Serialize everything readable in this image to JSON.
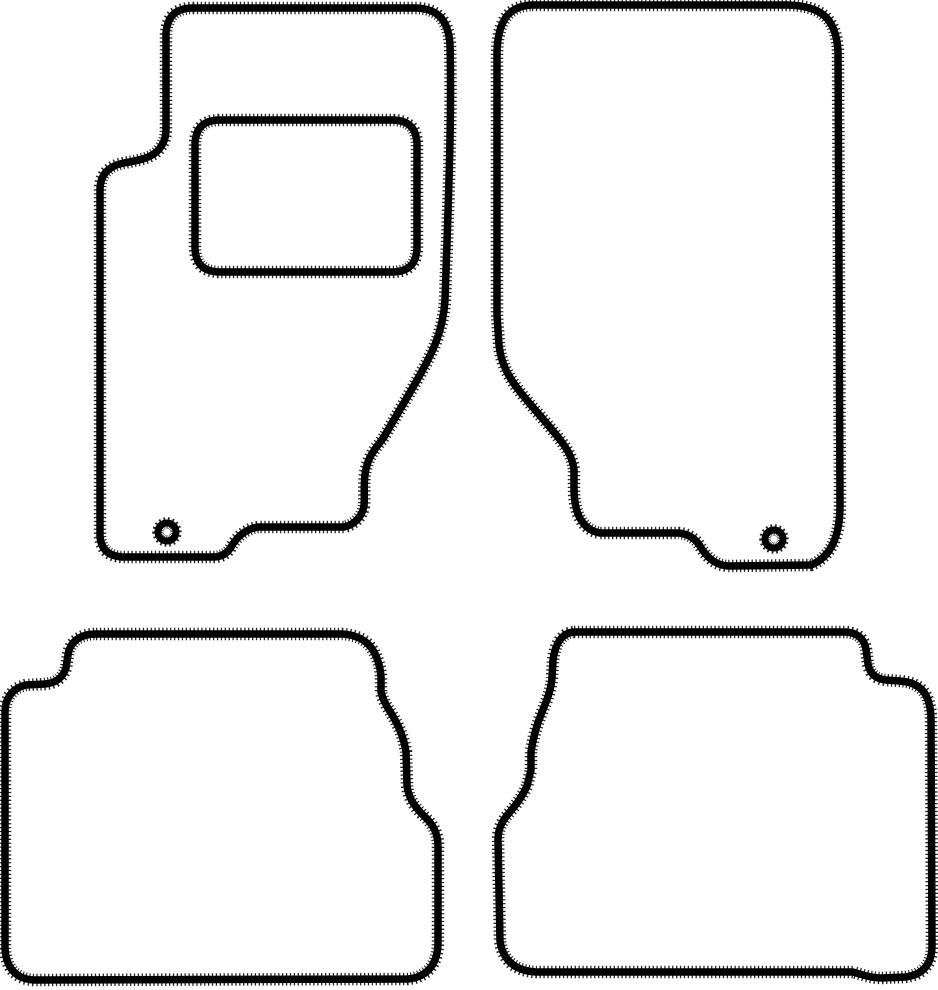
{
  "canvas": {
    "width": 938,
    "height": 990
  },
  "colors": {
    "background": "#ffffff",
    "line": "#000000"
  },
  "stroke": {
    "outline_width": 7.5,
    "texture_width": 12.5
  },
  "mats": {
    "front_left": {
      "name": "front-left-mat",
      "outline": "M 193,8 L 417,8 C 437,9 448,19 450,44 C 452,120 448,210 445,300 C 443,332 432,353 421,373 C 410,393 393,421 384,437 C 376,448 369,455 366,469 C 363,481 365,494 364,506 C 362,517 354,525 344,527 L 258,527 C 245,529 236,538 231,547 C 227,554 221,557 213,557 L 122,557 C 108,556 101,549 100,536 L 100,190 C 100,175 108,166 124,163 C 140,160 153,158 160,148 C 165,141 166,136 166,127 L 166,34 C 167,16 176,8 193,8 Z",
      "heel_pad": "M 218,120 L 394,120 C 409,121 416,128 417,143 L 417,249 C 416,264 409,271 394,272 L 218,272 C 203,271 196,264 195,249 L 195,143 C 196,128 203,121 218,120 Z",
      "eyelet": "M 158,532 a 9,9 0 1 0 18,0 a 9,9 0 1 0 -18,0 Z"
    },
    "front_right": {
      "name": "front-right-mat",
      "outline": "M 532,5 L 788,5 C 820,6 836,17 838,51 L 840,505 C 840,536 831,557 811,565 L 728,566 C 714,565 706,556 700,546 C 695,538 688,534 679,533 L 600,533 C 589,531 582,524 578,514 C 575,506 574,498 574,488 L 574,470 C 573,460 568,450 561,441 C 548,424 532,407 521,393 C 509,378 501,364 499,345 L 497,315 L 497,52 C 498,20 509,6 532,5 Z",
      "eyelet": "M 765,539 a 9,9 0 1 0 18,0 a 9,9 0 1 0 -18,0 Z"
    },
    "rear_left": {
      "name": "rear-left-mat",
      "outline": "M 96,634 L 342,634 C 358,635 368,641 374,652 C 378,659 380,666 381,676 L 381,692 C 383,700 387,707 391,713 C 399,726 404,738 406,752 L 407,785 C 408,797 414,806 422,814 C 432,823 438,832 438,846 L 438,942 C 438,962 429,977 408,979 L 34,980 C 16,979 6,968 5,948 L 5,712 C 5,699 12,688 26,685 L 45,684 C 57,683 63,677 66,668 L 68,655 C 70,641 81,634 96,634 Z"
    },
    "rear_right": {
      "name": "rear-right-mat",
      "outline": "M 574,632 L 846,632 C 858,633 864,639 866,649 L 868,664 C 870,674 876,679 886,680 L 900,681 C 914,682 924,688 928,700 C 930,706 931,712 931,720 L 932,946 C 932,964 923,975 905,977 L 882,978 C 872,978 862,975 853,972 L 536,972 C 516,971 503,961 500,941 L 498,840 C 498,828 503,820 509,813 C 517,804 523,795 527,786 L 531,770 L 531,752 C 533,738 537,724 542,712 C 547,700 551,690 552,678 L 553,660 C 555,645 561,633 574,632 Z"
    }
  }
}
